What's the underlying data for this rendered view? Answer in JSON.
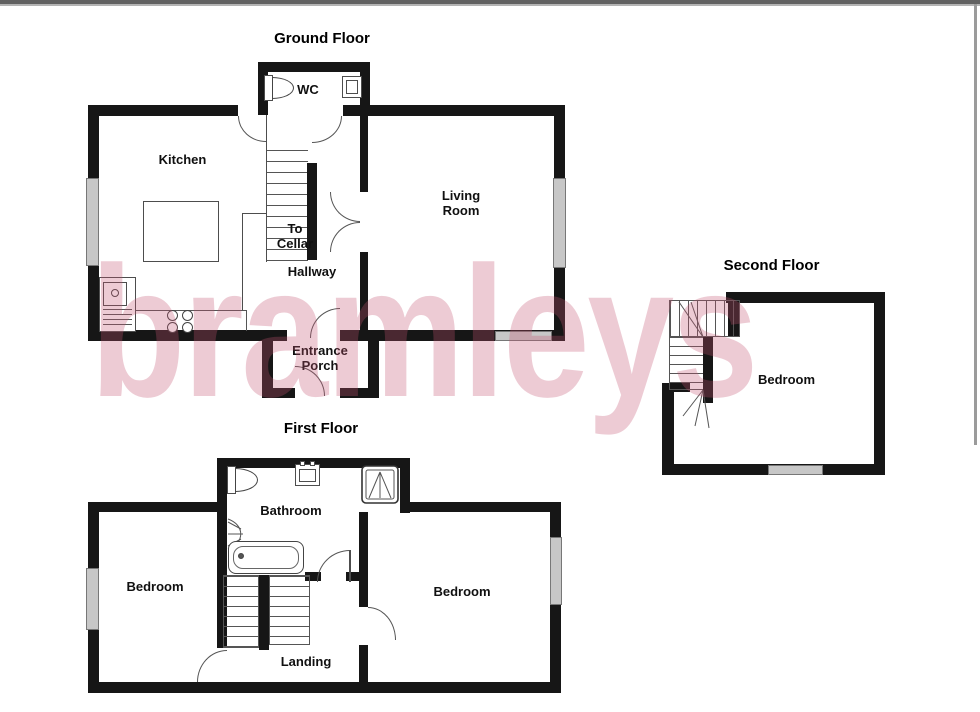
{
  "watermark": {
    "text": "bramleys",
    "color": "rgba(196,84,114,0.30)"
  },
  "frame": {
    "top_bar_color": "#616161",
    "edge_color": "#9b9b9b"
  },
  "colors": {
    "wall": "#161616",
    "thin_line": "#4d4d4d",
    "window_fill": "#c7c7c7",
    "label_text": "#101010"
  },
  "ground_floor": {
    "title": "Ground Floor",
    "labels": {
      "wc": "WC",
      "kitchen": "Kitchen",
      "to_cellar": "To\nCellar",
      "hallway": "Hallway",
      "living_room": "Living\nRoom",
      "entrance_porch": "Entrance\nPorch"
    }
  },
  "first_floor": {
    "title": "First Floor",
    "labels": {
      "bathroom": "Bathroom",
      "bedroom_left": "Bedroom",
      "bedroom_right": "Bedroom",
      "landing": "Landing"
    }
  },
  "second_floor": {
    "title": "Second Floor",
    "labels": {
      "bedroom": "Bedroom"
    }
  }
}
